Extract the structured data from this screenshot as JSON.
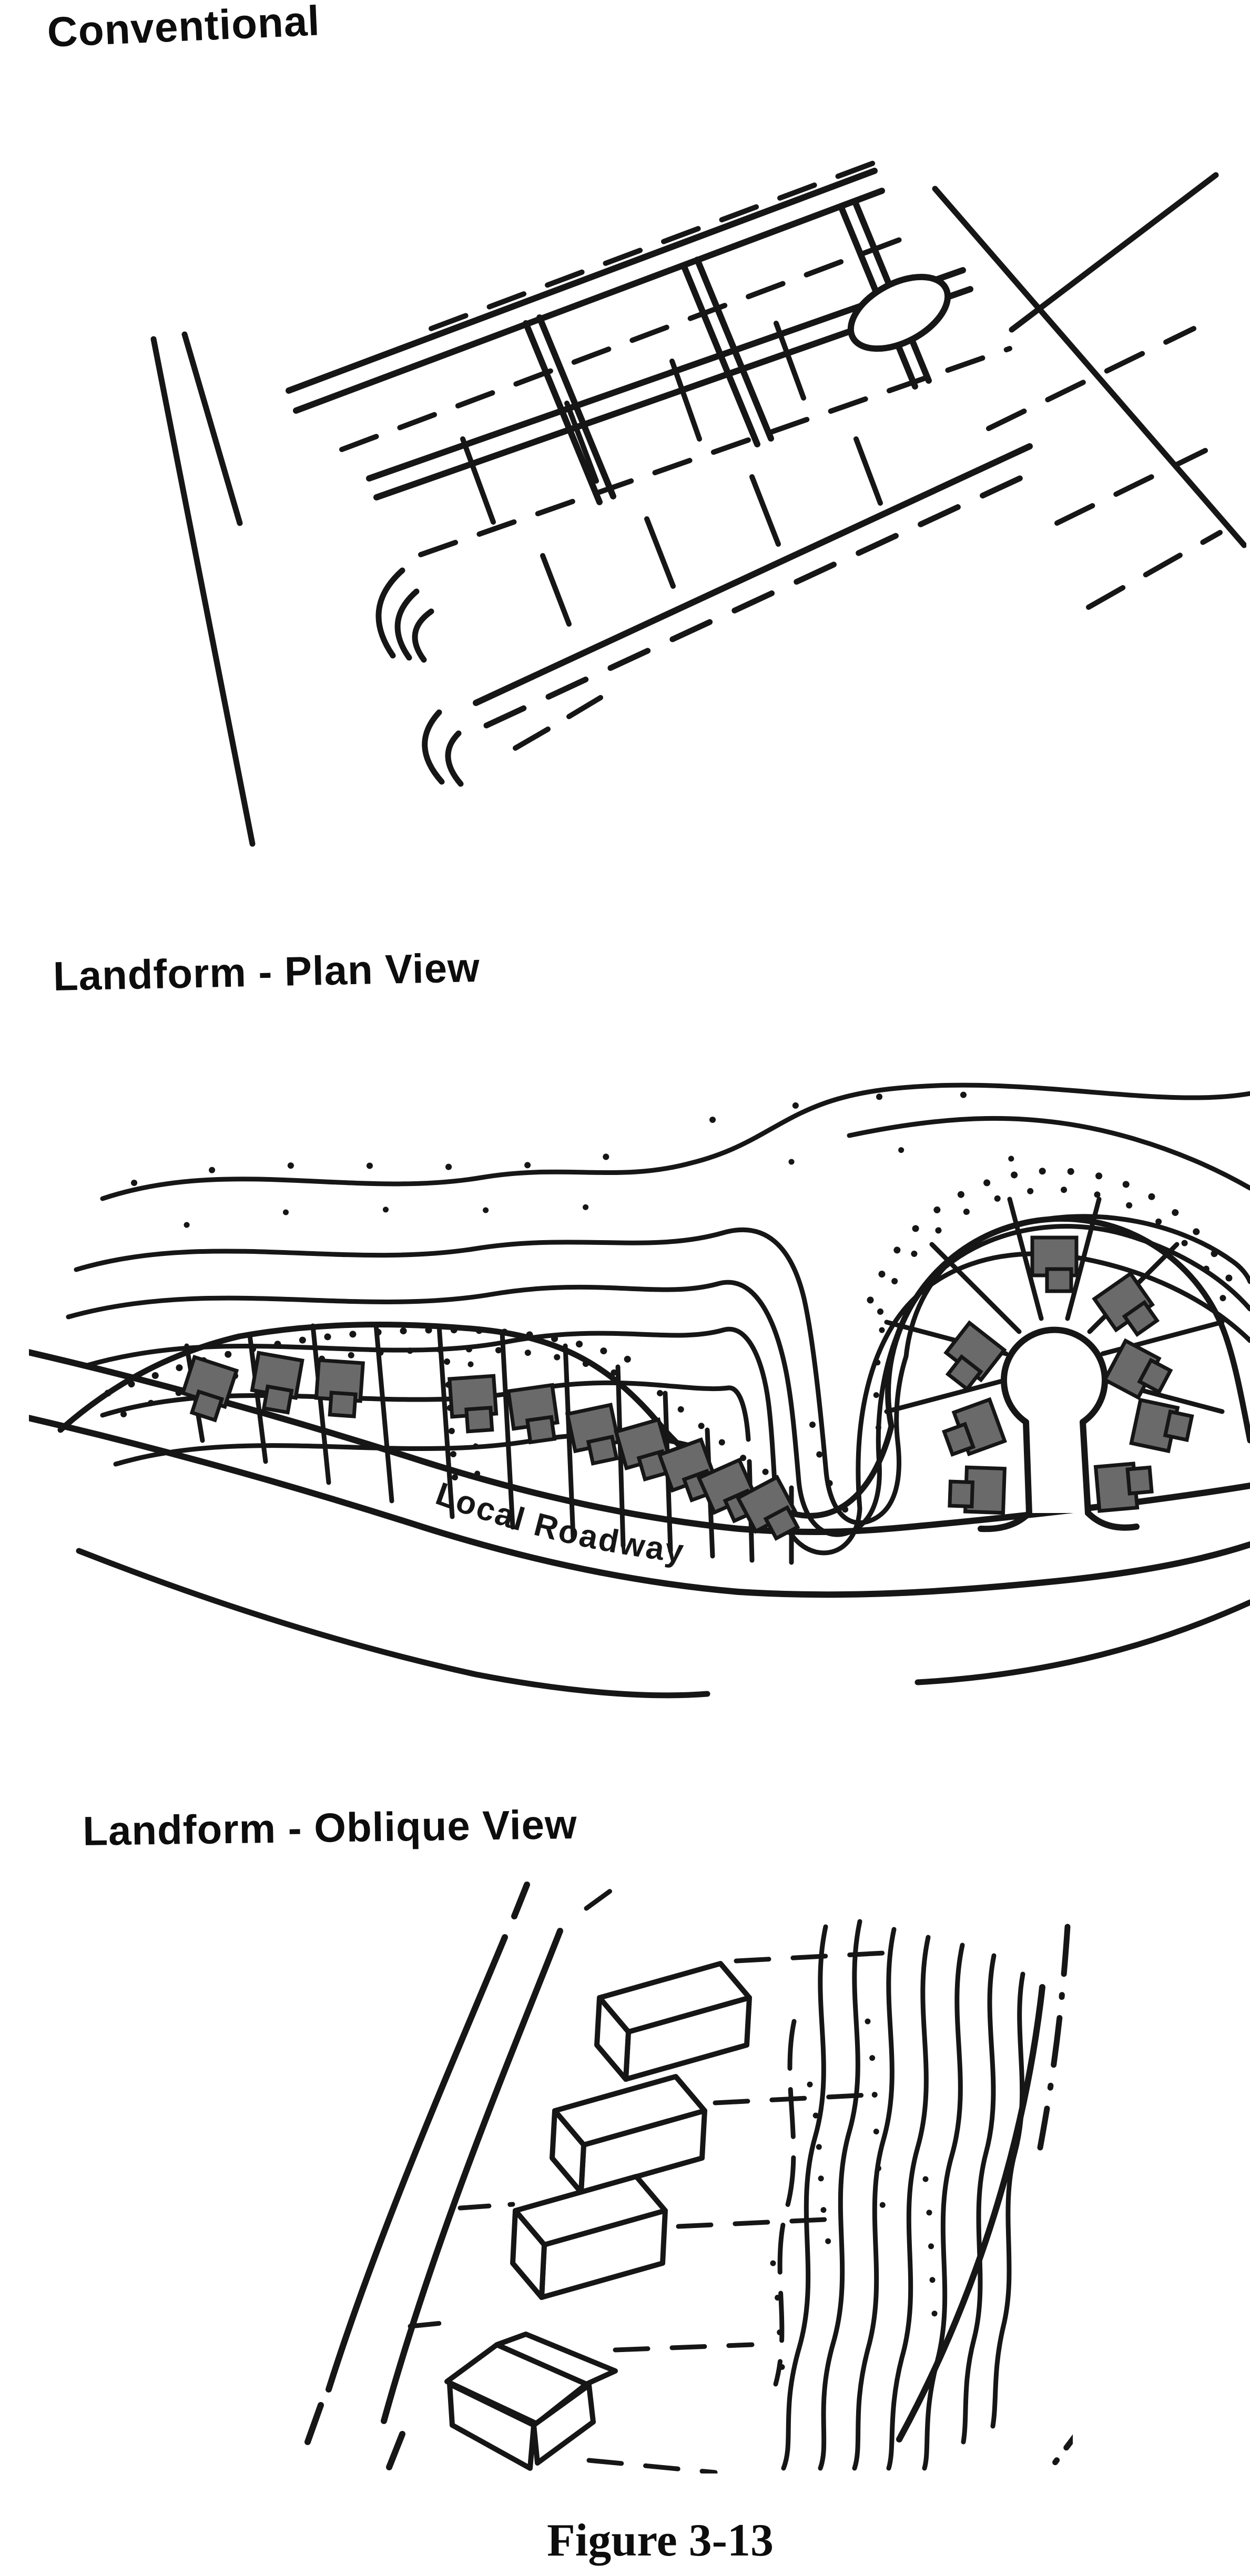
{
  "colors": {
    "ink": "#161616",
    "house_fill": "#6a6a6a",
    "paper": "#ffffff"
  },
  "sections": {
    "conventional": {
      "title": "Conventional"
    },
    "plan": {
      "title": "Landform - Plan View",
      "road_label": "Local Roadway"
    },
    "oblique": {
      "title": "Landform - Oblique View"
    }
  },
  "caption": {
    "text": "Figure 3-13"
  }
}
